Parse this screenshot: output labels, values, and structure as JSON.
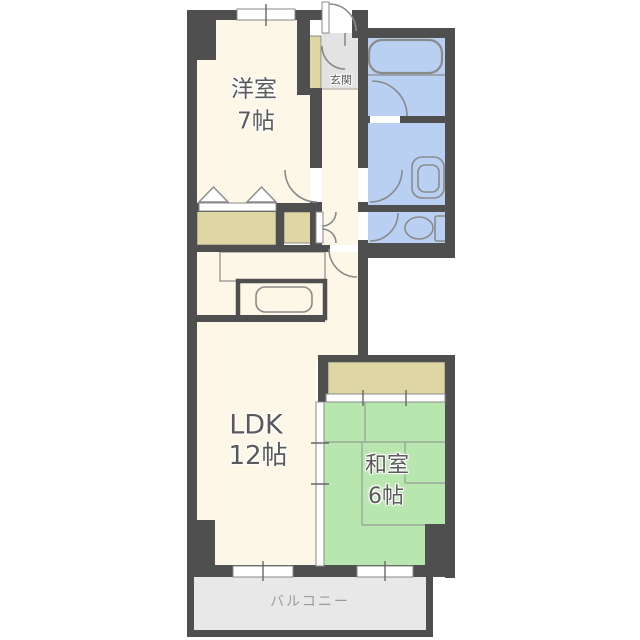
{
  "floorplan": {
    "rooms": {
      "western": {
        "label": "洋室",
        "size": "7帖"
      },
      "ldk": {
        "label": "LDK",
        "size": "12帖"
      },
      "japanese": {
        "label": "和室",
        "size": "6帖"
      },
      "entrance": {
        "label": "玄関"
      },
      "balcony": {
        "label": "バルコニー"
      }
    },
    "fixtures": [
      "bathtub",
      "wash-basin",
      "toilet",
      "kitchen-sink",
      "closet",
      "sliding-doors",
      "windows",
      "door-swings"
    ],
    "colors": {
      "background": "#ffffff",
      "wall": "#4F4F4F",
      "line": "#8A8A8A",
      "western_floor": "#FCF7E6",
      "wet_area_floor": "#BAD0F2",
      "tatami_floor": "#B7E6AE",
      "closet_floor": "#DED7A3",
      "entrance_floor": "#E3E3E3",
      "balcony_floor": "#E8E8E8",
      "tatami_line": "#9AA89A",
      "room_text": "#5A5A5A",
      "balcony_text": "#9B9B9B"
    }
  }
}
